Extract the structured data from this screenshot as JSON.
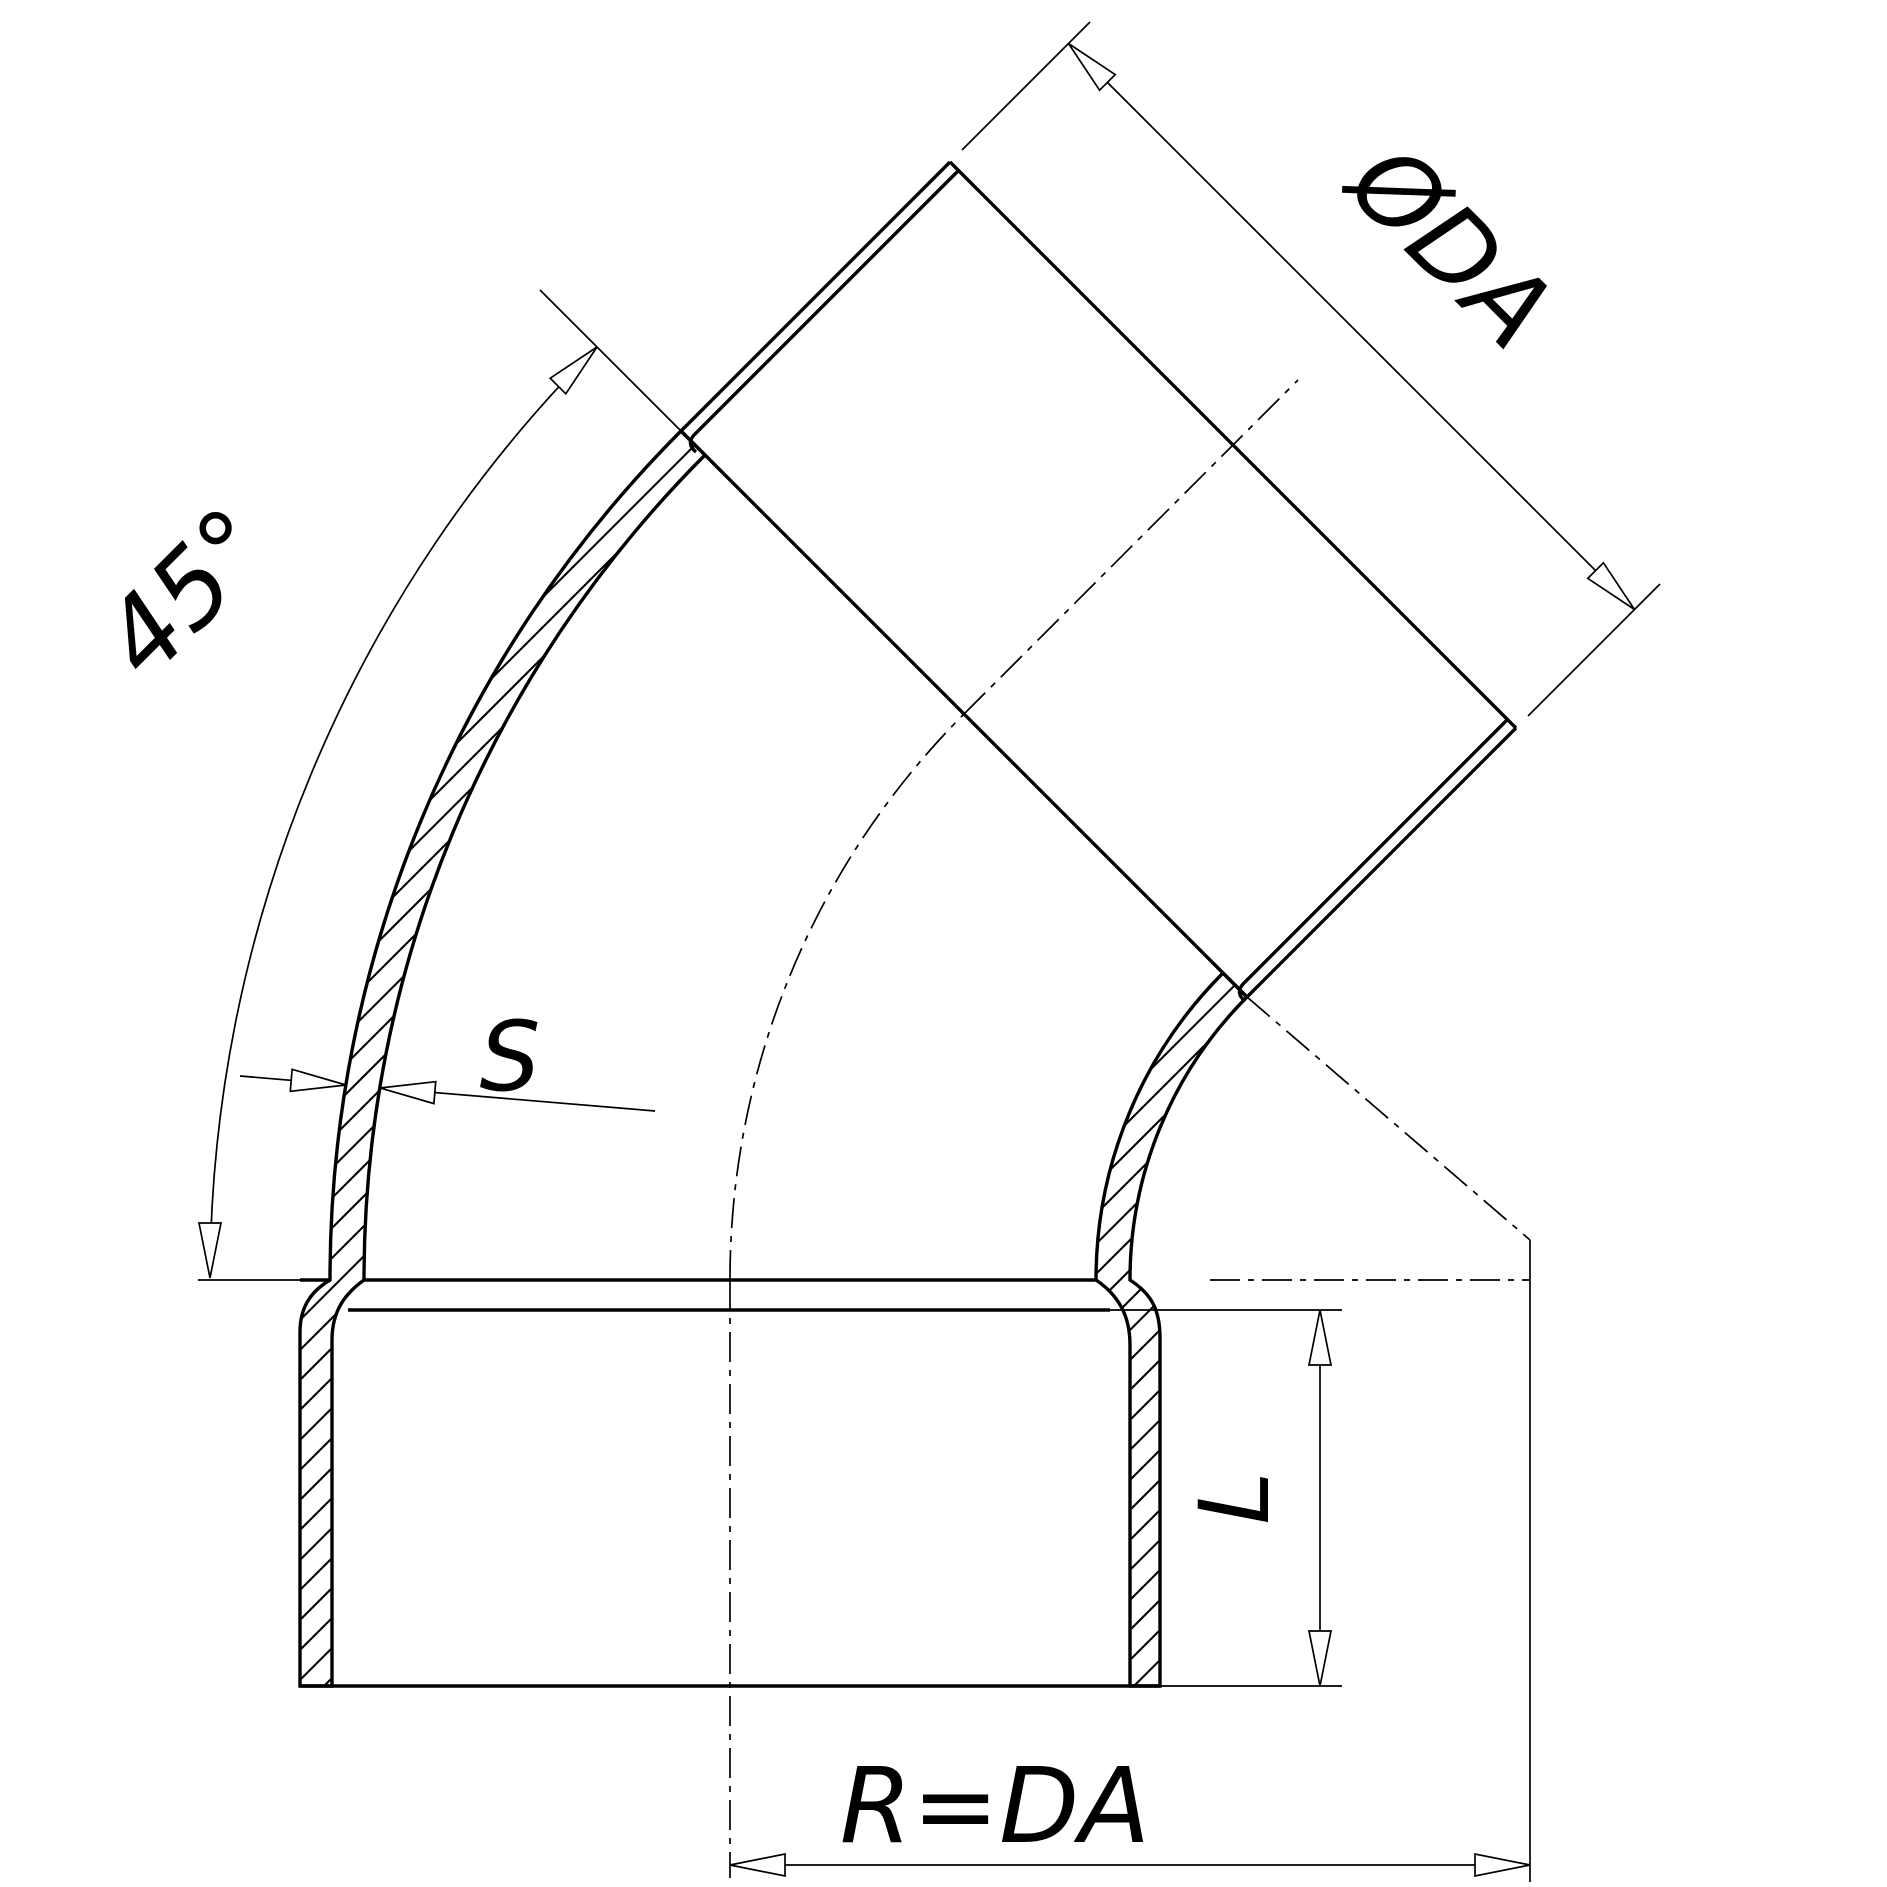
{
  "labels": {
    "diameter": "ØDA",
    "angle": "45°",
    "wall_thickness": "S",
    "insertion_length": "L",
    "bend_radius": "R=DA"
  },
  "colors": {
    "ink": "#000000",
    "paper": "#ffffff"
  }
}
